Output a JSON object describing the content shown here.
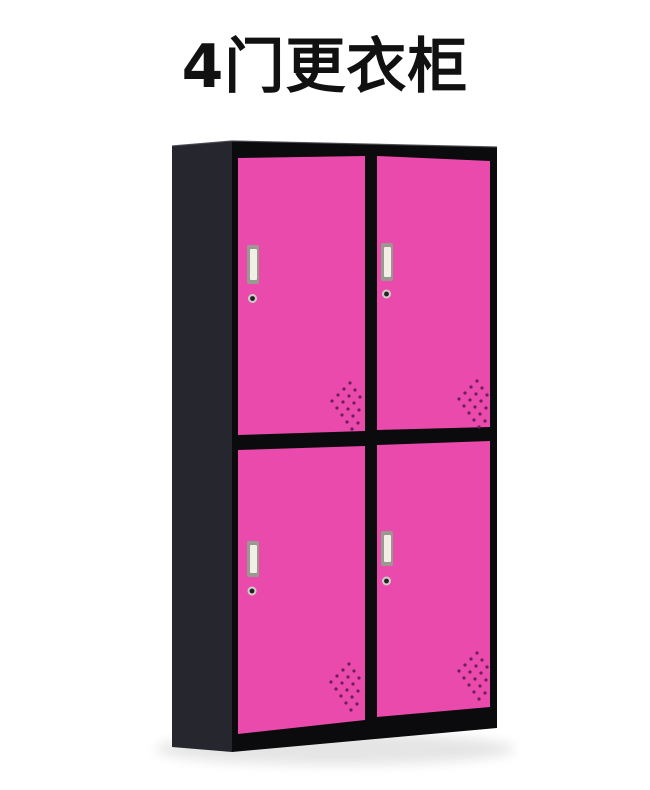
{
  "title": "4门更衣柜",
  "cabinet": {
    "door_count": 4,
    "doors": [
      "top-left",
      "top-right",
      "bottom-left",
      "bottom-right"
    ],
    "features": [
      "recessed-handle",
      "keyhole-lock",
      "vent-grille"
    ]
  },
  "colors": {
    "background": "#ffffff",
    "title": "#111111",
    "frame": "#0b0b0d",
    "side_panel": "#26262e",
    "edge_highlight": "#45454d",
    "door": "#ea4aac",
    "handle_frame": "#999992",
    "handle_face": "#f2f0e4",
    "keyhole_ring": "#cccdc8",
    "keyhole_center": "#222222",
    "vent_dot": "#6e1f58",
    "shadow": "#000000"
  }
}
